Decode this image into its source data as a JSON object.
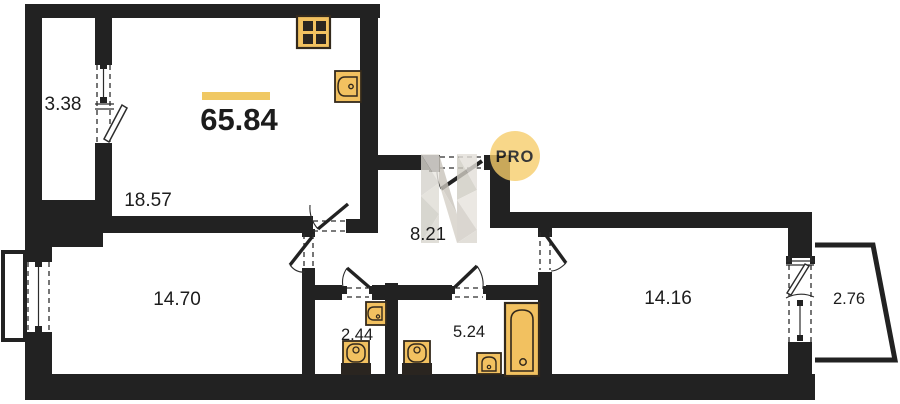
{
  "plan": {
    "total_area": "65.84",
    "rooms": [
      {
        "name": "balcony-left",
        "area": "3.38"
      },
      {
        "name": "kitchen-living",
        "area": "18.57"
      },
      {
        "name": "hallway",
        "area": "8.21"
      },
      {
        "name": "room-left",
        "area": "14.70"
      },
      {
        "name": "wc",
        "area": "2.44"
      },
      {
        "name": "bathroom",
        "area": "5.24"
      },
      {
        "name": "room-right",
        "area": "14.16"
      },
      {
        "name": "balcony-right",
        "area": "2.76"
      }
    ],
    "watermark": {
      "label": "PRO"
    },
    "colors": {
      "wall": "#222222",
      "fixture_fill": "#f2c160",
      "accent_bar": "#f0c863",
      "watermark_circle": "#f5cc69",
      "watermark_text": "#8f8d83"
    }
  }
}
